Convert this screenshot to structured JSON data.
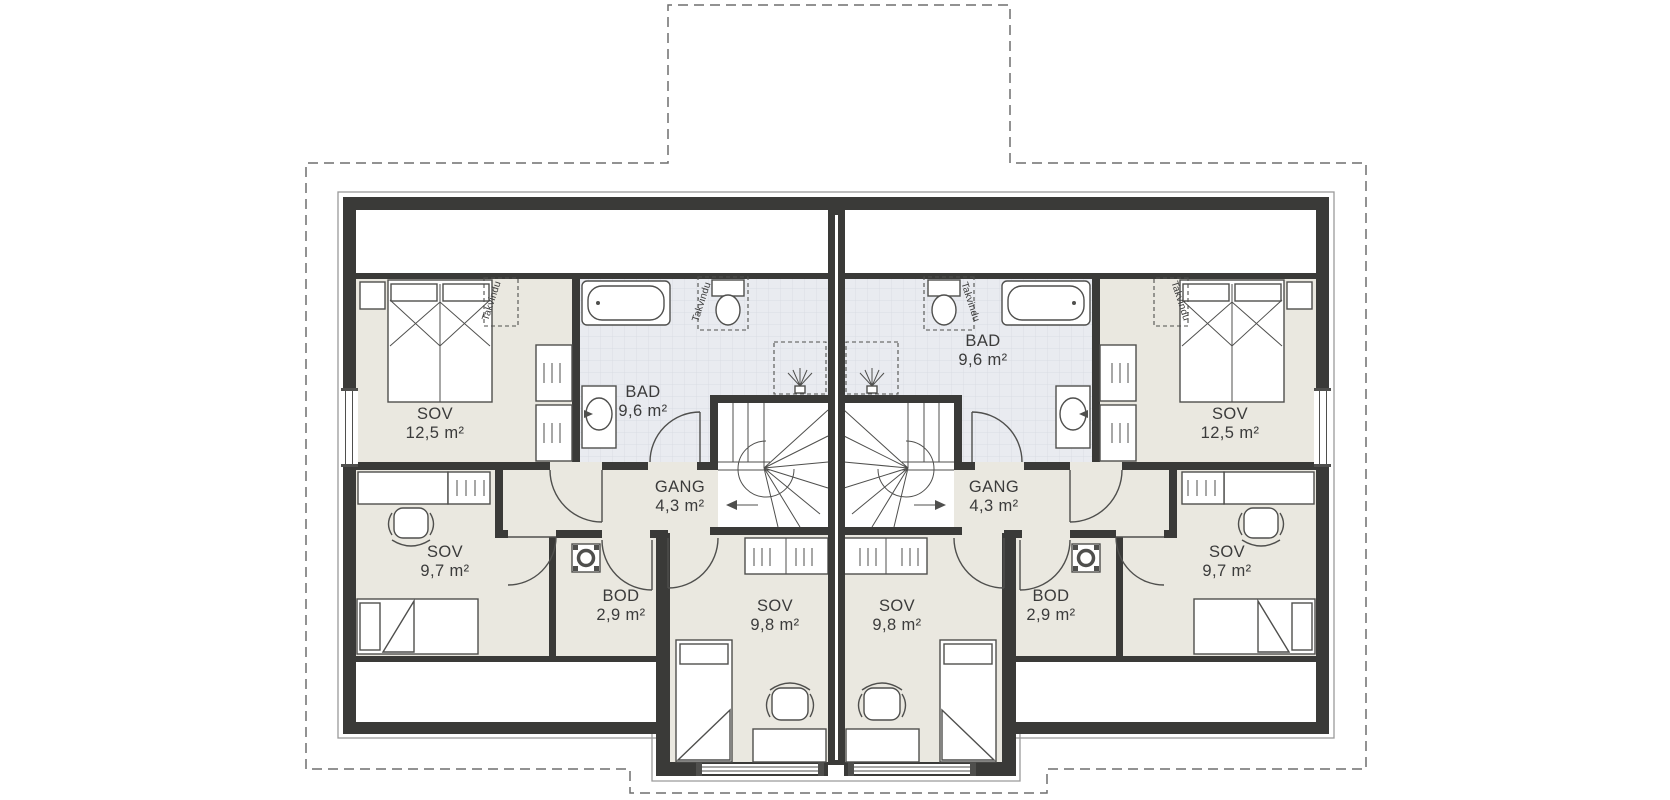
{
  "plan": {
    "kind": "floor-plan",
    "rooms": {
      "sov_large": {
        "name": "SOV",
        "area": "12,5 m²"
      },
      "bad": {
        "name": "BAD",
        "area": "9,6 m²"
      },
      "gang": {
        "name": "GANG",
        "area": "4,3 m²"
      },
      "sov_small": {
        "name": "SOV",
        "area": "9,7 m²"
      },
      "bod": {
        "name": "BOD",
        "area": "2,9 m²"
      },
      "sov_mid": {
        "name": "SOV",
        "area": "9,8 m²"
      }
    },
    "annotations": {
      "roof_window": "Takvindu"
    }
  },
  "colors": {
    "wall": "#3a3a38",
    "floor": "#eae8e0",
    "tilebg": "#e9ebf0",
    "tileline": "#d9dce3",
    "line": "#4f4f4d",
    "outline": "#9a9a9a",
    "dash": "#6f6f6f",
    "text": "#3b3b3b"
  }
}
